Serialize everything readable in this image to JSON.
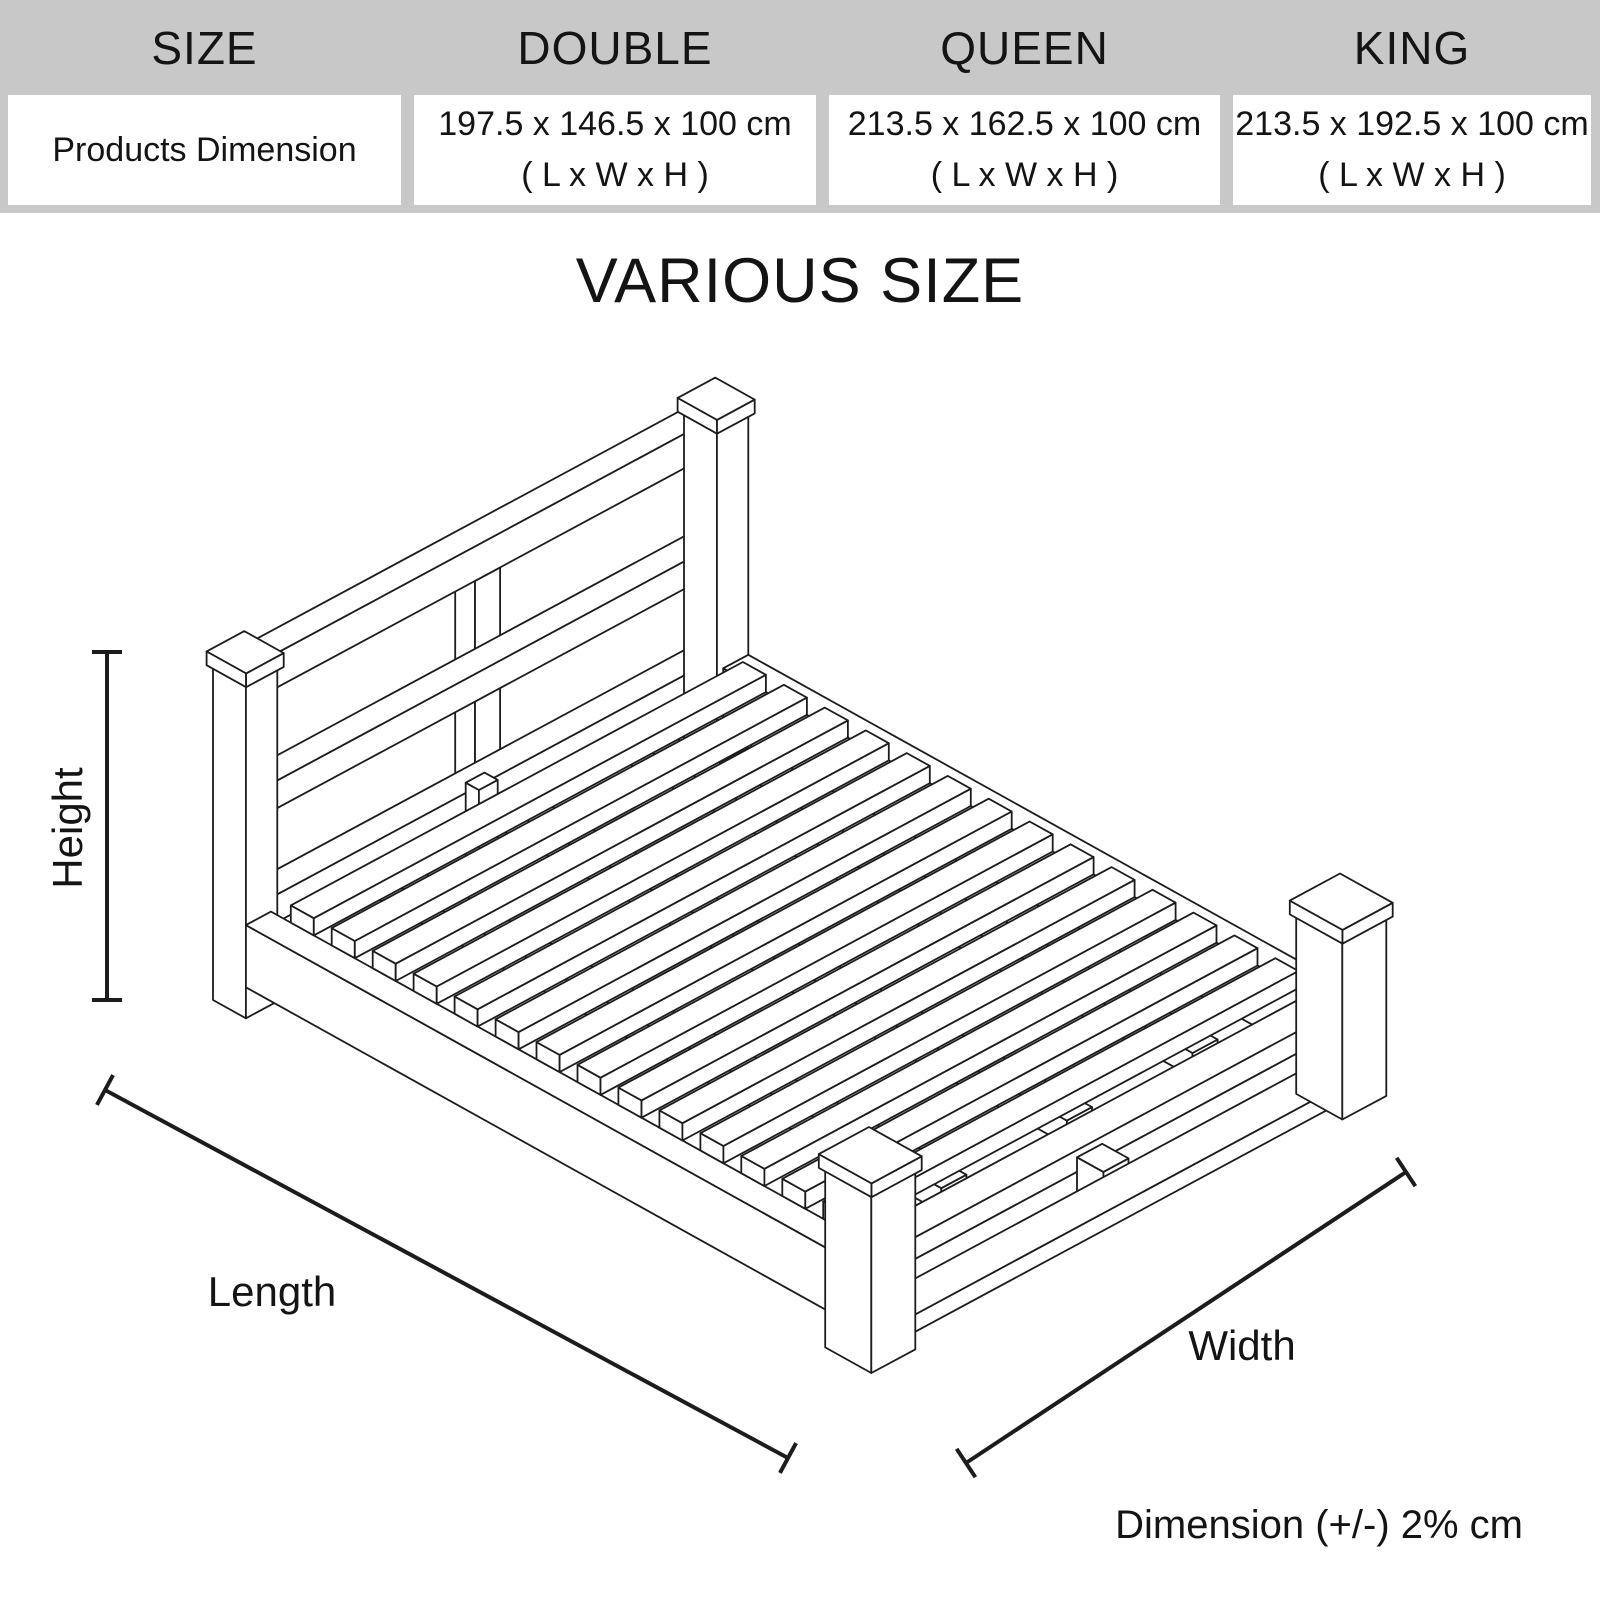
{
  "title": "VARIOUS SIZE",
  "table": {
    "headers": [
      "SIZE",
      "DOUBLE",
      "QUEEN",
      "KING"
    ],
    "row_label": "Products Dimension",
    "cells": [
      {
        "dimensions": "197.5 x 146.5 x 100 cm",
        "unit_note": "( L x W x H )"
      },
      {
        "dimensions": "213.5 x 162.5 x 100 cm",
        "unit_note": "( L x W x H )"
      },
      {
        "dimensions": "213.5 x 192.5 x 100 cm",
        "unit_note": "( L x W x H )"
      }
    ]
  },
  "diagram": {
    "labels": {
      "height": "Height",
      "length": "Length",
      "width": "Width"
    },
    "note": "Dimension (+/-) 2% cm"
  },
  "colors": {
    "header_bg": "#c8c8c8",
    "ink": "#141414",
    "line": "#1c1c1c"
  }
}
